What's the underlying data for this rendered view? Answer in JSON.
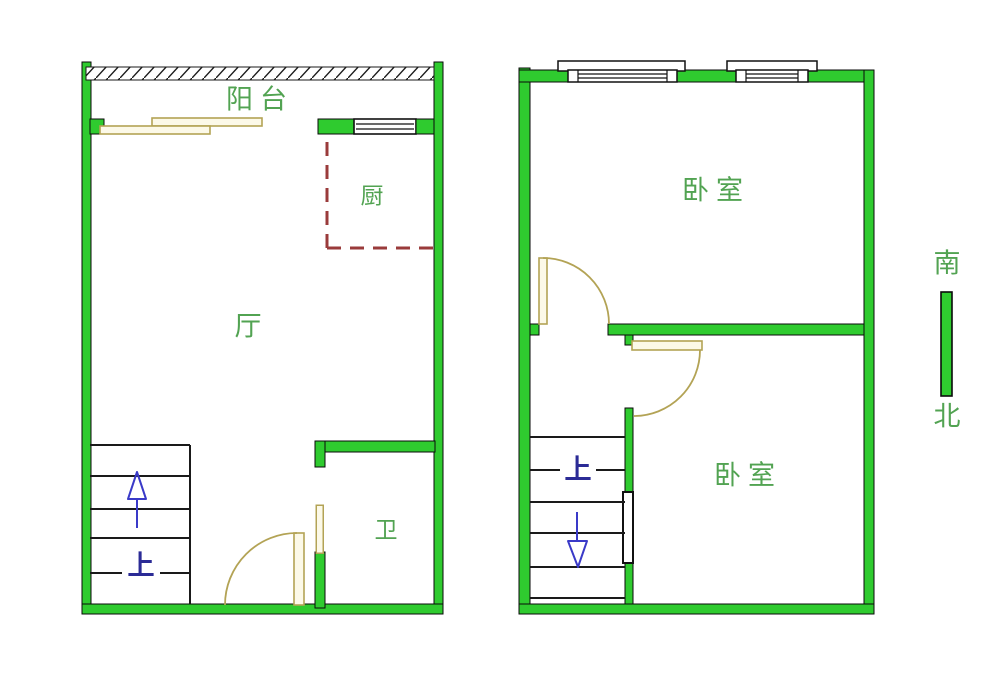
{
  "colors": {
    "wall_green": "#2fcb2f",
    "label_green": "#52a352",
    "door_tan": "#b3a355",
    "kitchen_dash_red": "#9a3b3b",
    "stair_navy": "#2b2b96",
    "line_black": "#1a1a1a"
  },
  "floor1": {
    "balcony_label": "阳台",
    "living_label": "厅",
    "kitchen_label": "厨",
    "bath_label": "卫",
    "stairs_label": "上"
  },
  "floor2": {
    "bedroom_top_label": "卧室",
    "bedroom_bottom_label": "卧室",
    "stairs_label": "上"
  },
  "compass": {
    "south_label": "南",
    "north_label": "北"
  }
}
